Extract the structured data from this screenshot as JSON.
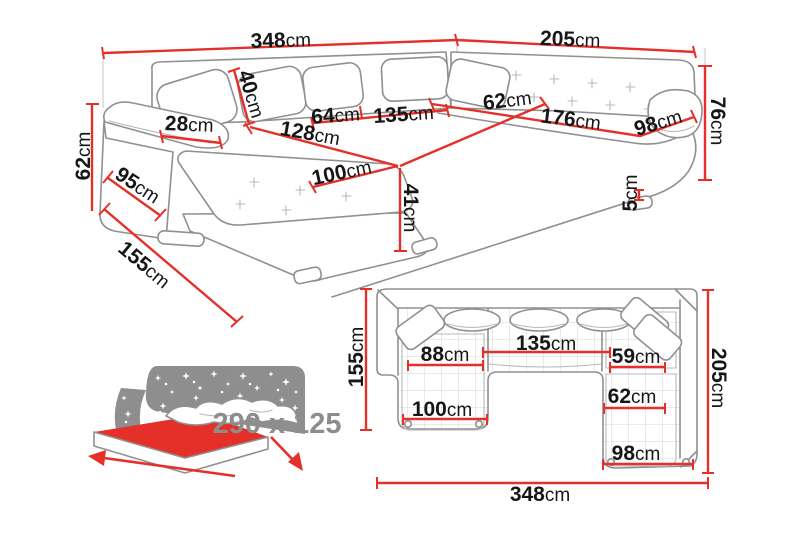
{
  "colors": {
    "dimension_red": "#e5302a",
    "sofa_outline_gray": "#909090",
    "label_text": "#161616",
    "muted_gray": "#8d8d8d"
  },
  "perspective_view": {
    "total_back_width": {
      "value": "348",
      "unit": "cm"
    },
    "right_back_width": {
      "value": "205",
      "unit": "cm"
    },
    "armrest_height": {
      "value": "62",
      "unit": "cm"
    },
    "chaise_total_depth": {
      "value": "155",
      "unit": "cm"
    },
    "arm_section_depth": {
      "value": "95",
      "unit": "cm"
    },
    "armrest_width": {
      "value": "28",
      "unit": "cm"
    },
    "back_cushion_height": {
      "value": "40",
      "unit": "cm"
    },
    "seat_section_64": {
      "value": "64",
      "unit": "cm"
    },
    "seat_section_135": {
      "value": "135",
      "unit": "cm"
    },
    "chaise_length": {
      "value": "128",
      "unit": "cm"
    },
    "chaise_width": {
      "value": "100",
      "unit": "cm"
    },
    "seat_height": {
      "value": "41",
      "unit": "cm"
    },
    "corner_seat_depth": {
      "value": "62",
      "unit": "cm"
    },
    "right_seat_length": {
      "value": "176",
      "unit": "cm"
    },
    "right_end_width": {
      "value": "98",
      "unit": "cm"
    },
    "backrest_height": {
      "value": "76",
      "unit": "cm"
    },
    "leg_height": {
      "value": "5",
      "unit": "cm"
    }
  },
  "plan_view": {
    "depth_left": {
      "value": "155",
      "unit": "cm"
    },
    "depth_right": {
      "value": "205",
      "unit": "cm"
    },
    "total_width": {
      "value": "348",
      "unit": "cm"
    },
    "chaise_seat_width": {
      "value": "88",
      "unit": "cm"
    },
    "middle_seat_width": {
      "value": "135",
      "unit": "cm"
    },
    "right_seat_width_upper": {
      "value": "59",
      "unit": "cm"
    },
    "chaise_width": {
      "value": "100",
      "unit": "cm"
    },
    "right_seat_width_lower": {
      "value": "62",
      "unit": "cm"
    },
    "right_end_width": {
      "value": "98",
      "unit": "cm"
    }
  },
  "sleeping_area": {
    "label": "290 x 125"
  }
}
